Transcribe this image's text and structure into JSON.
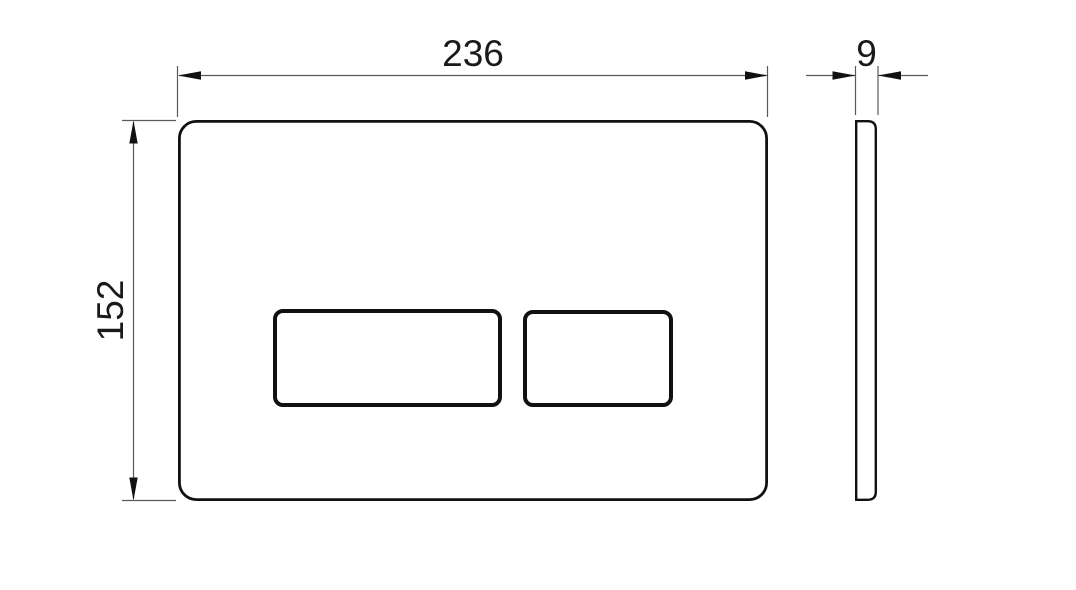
{
  "drawing": {
    "background": "#ffffff",
    "outline_color": "#111111",
    "dimension_line_color": "#5a5a5a",
    "text_color": "#1a1a1a",
    "dimensions": {
      "front_width": "236",
      "front_height": "152",
      "side_thickness": "9"
    }
  }
}
